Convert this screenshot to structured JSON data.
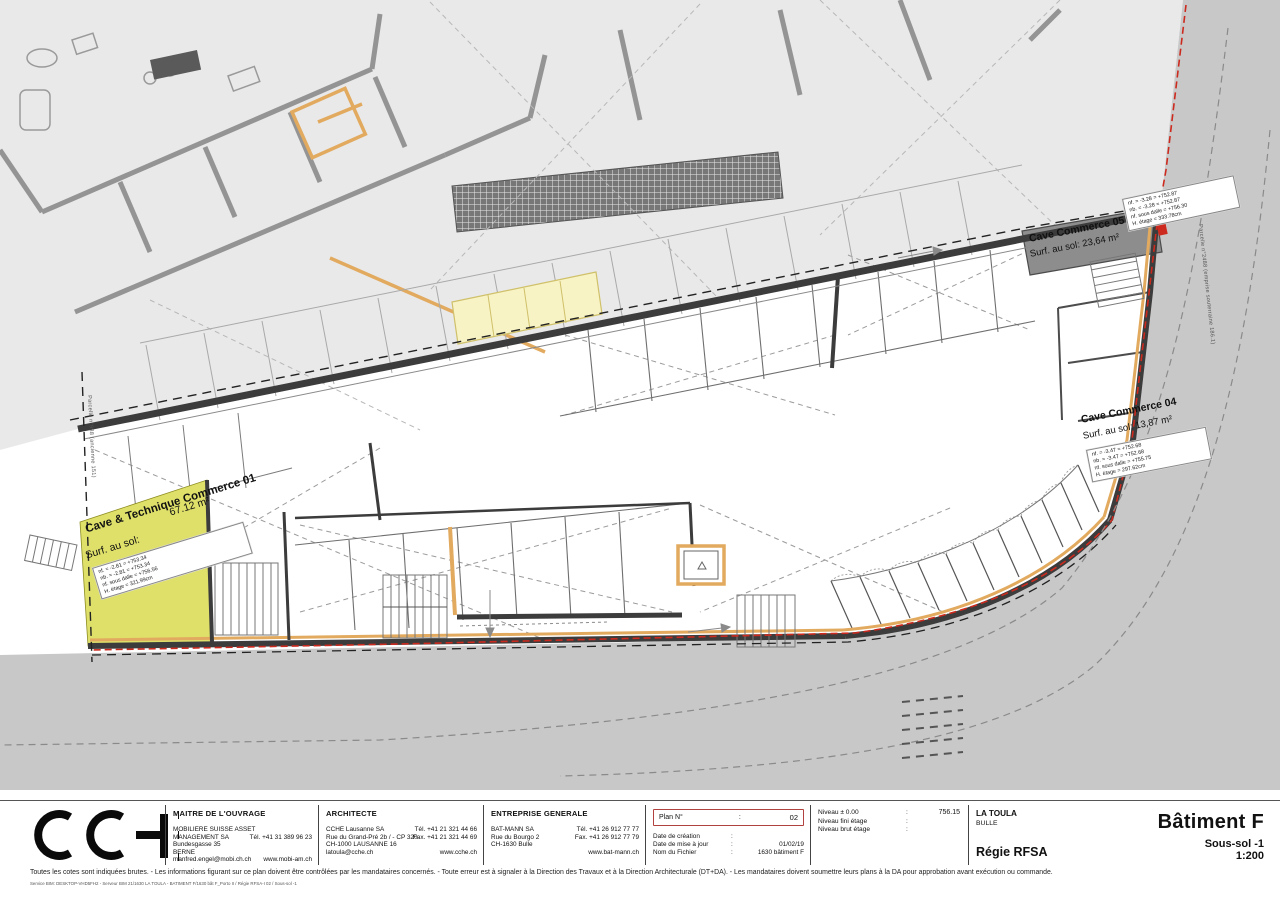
{
  "drawing": {
    "rooms": {
      "cave_technique_01": {
        "name": "Cave & Technique Commerce 01",
        "area": "67.12 m²",
        "surface_prefix": "Surf. au sol:",
        "levels": {
          "l1": "nf. = -2.81 = +753.34",
          "l2": "nb. = -2.81 = +753.34",
          "l3": "nf. sous dalle = +756.56",
          "l4": "H. étage = 321.99cm"
        }
      },
      "cave_commerce_05": {
        "name": "Cave Commerce 05",
        "surface": "Surf. au sol: 23,64 m²"
      },
      "cave_commerce_04": {
        "name": "Cave Commerce 04",
        "surface": "Surf. au sol: 13,87 m²",
        "levels": {
          "l1": "nf. = -3.47 = +752.68",
          "l2": "nb. = -3.47 = +752.68",
          "l3": "nf. sous dalle = +755.75",
          "l4": "H. étage = 297.62cm"
        }
      },
      "corner_levels": {
        "l1": "nf. = -3.28 = +752.87",
        "l2": "nb. = -3.28 = +752.87",
        "l3": "nf. sous dalle = +756.30",
        "l4": "H. étage = 333.78cm"
      }
    },
    "parcels": {
      "left": "Parcelle n°988 (ancienne 151)",
      "right": "Parcelle n°2488 (emprise souterraine 186.1)"
    },
    "colors": {
      "accent_wood": "#e2aa5f",
      "room_highlight": "#dfe06a",
      "parcel_line": "#cc2a1e",
      "road": "#c8c8c8",
      "site": "#e9e9e9"
    }
  },
  "title_block": {
    "logo_text": "CCHE",
    "owner": {
      "header": "MAITRE DE L'OUVRAGE",
      "name1": "MOBILIERE SUISSE ASSET",
      "name2": "MANAGEMENT SA",
      "street": "Bundesgasse 35",
      "city": "BERNE",
      "email": "manfred.engel@mobi.ch.ch",
      "tel": "Tél.  +41 31 389 96 23",
      "web": "www.mobi-am.ch"
    },
    "architect": {
      "header": "ARCHITECTE",
      "name": "CCHE Lausanne SA",
      "street": "Rue du Grand-Pré 2b / - CP 320",
      "city": "CH-1000 LAUSANNE 16",
      "email": "latoula@cche.ch",
      "tel": "Tél. +41 21 321 44 66",
      "fax": "Fax. +41 21 321 44 69",
      "web": "www.cche.ch"
    },
    "general_contractor": {
      "header": "ENTREPRISE GENERALE",
      "name": "BAT-MANN SA",
      "street": "Rue du Bourgo 2",
      "city": "CH-1630 Bulle",
      "tel": "Tél. +41 26 912 77 77",
      "fax": "Fax. +41 26 912 77 79",
      "web": "www.bat-mann.ch"
    },
    "plan_info": {
      "plan_no_label": "Plan N°",
      "colon": ":",
      "plan_no": "02",
      "rows": [
        {
          "label": "Date de création",
          "colon": ":",
          "value": ""
        },
        {
          "label": "Date de mise à jour",
          "colon": ":",
          "value": "01/02/19"
        },
        {
          "label": "Nom du Fichier",
          "colon": ":",
          "value": "1630 bâtiment F"
        }
      ]
    },
    "levels": {
      "rows": [
        {
          "label": "Niveau ± 0.00",
          "colon": ":"
        },
        {
          "label": "Niveau fini étage",
          "colon": ":"
        },
        {
          "label": "Niveau brut étage",
          "colon": ":"
        }
      ],
      "datum": "756.15"
    },
    "project": {
      "name": "LA TOULA",
      "city": "BULLE",
      "client": "Régie RFSA"
    },
    "sheet": {
      "building": "Bâtiment F",
      "floor": "Sous-sol -1",
      "scale": "1:200"
    }
  },
  "footer": {
    "note": "Toutes les cotes sont indiquées brutes. - Les informations figurant sur ce plan doivent être contrôlées par les mandataires concernés. - Toute erreur est à signaler à la Direction des Travaux et à la Direction Architecturale (DT+DA). - Les mandataires doivent soumettre leurs plans à la DA pour approbation avant exécution ou commande.",
    "path": "Service BIM: DESKTOP-VHD5FH2 - Serveur BIM 21/1630 LA TOULA - BATIMENT F/1630 bât F_Porto II / Régie RFSA-I 02 / Sous-sol -1"
  }
}
